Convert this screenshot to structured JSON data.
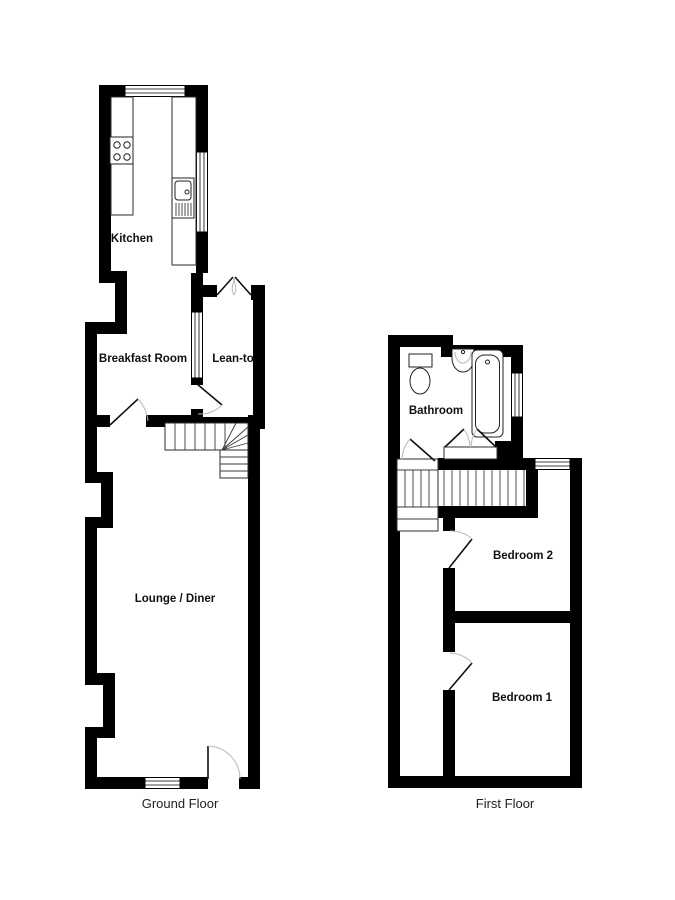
{
  "floorplan": {
    "ground_floor": {
      "label": "Ground Floor",
      "rooms": {
        "kitchen": "Kitchen",
        "breakfast": "Breakfast Room",
        "leanto": "Lean-to",
        "lounge": "Lounge / Diner"
      }
    },
    "first_floor": {
      "label": "First Floor",
      "rooms": {
        "bathroom": "Bathroom",
        "bedroom2": "Bedroom 2",
        "bedroom1": "Bedroom 1"
      }
    },
    "fixtures": [
      "stove",
      "sink",
      "toilet",
      "basin",
      "bathtub"
    ],
    "colors": {
      "wall": "#000000",
      "background": "#ffffff",
      "door_arc": "#b9b9b9"
    }
  }
}
